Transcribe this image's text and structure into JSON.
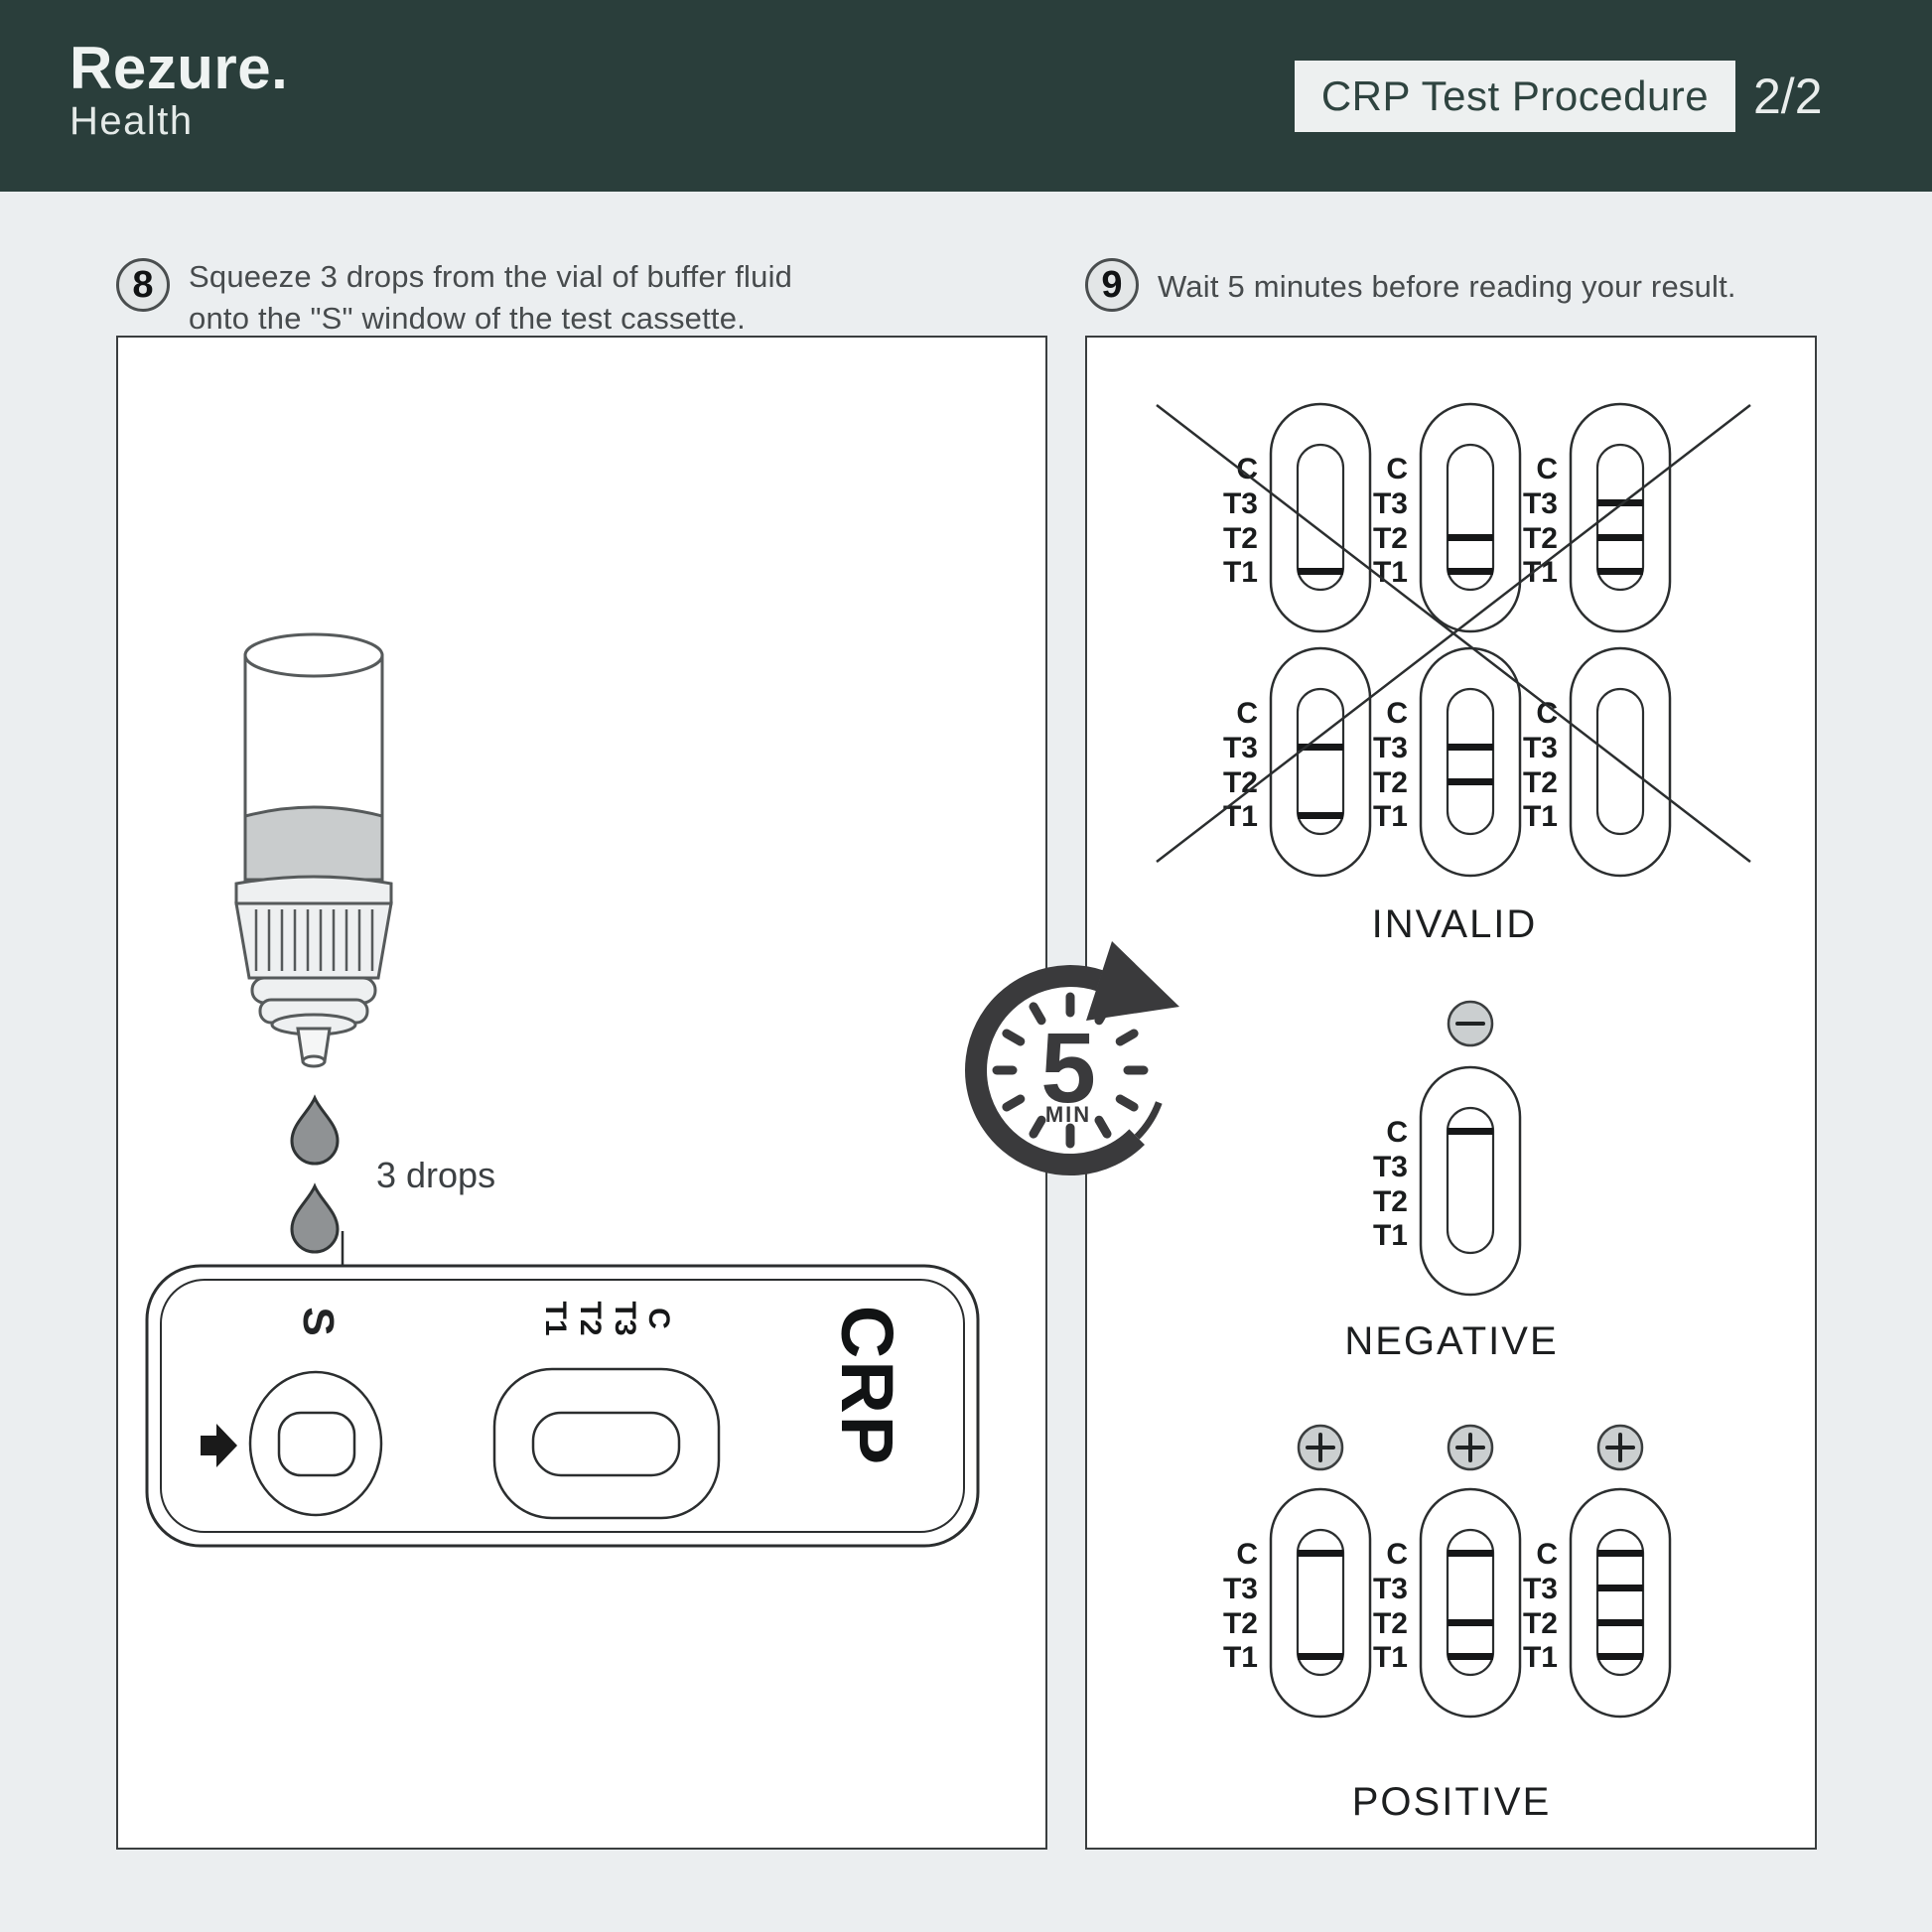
{
  "header": {
    "brand": "Rezure.",
    "brand_sub": "Health",
    "title": "CRP Test Procedure",
    "page_indicator": "2/2"
  },
  "steps": {
    "step8": {
      "number": "8",
      "line1": "Squeeze 3 drops from the vial of buffer fluid",
      "line2": "onto the \"S\" window of the test cassette."
    },
    "step9": {
      "number": "9",
      "line1": "Wait 5 minutes before reading your result."
    }
  },
  "left_panel": {
    "drops_annotation": "3 drops",
    "cassette": {
      "sample_well_label": "S",
      "window_labels": [
        "T1",
        "T2",
        "T3",
        "C"
      ],
      "assay_name": "CRP"
    }
  },
  "timer": {
    "value": "5",
    "unit": "MIN"
  },
  "results_panel": {
    "row_labels": [
      "C",
      "T3",
      "T2",
      "T1"
    ],
    "sections": [
      {
        "id": "invalid",
        "label": "INVALID",
        "crossed": true,
        "badge": null,
        "cassettes": [
          {
            "lines": [
              "T1"
            ]
          },
          {
            "lines": [
              "T2",
              "T1"
            ]
          },
          {
            "lines": [
              "T3",
              "T2",
              "T1"
            ]
          },
          {
            "lines": [
              "T3",
              "T1"
            ]
          },
          {
            "lines": [
              "T3",
              "T2"
            ]
          },
          {
            "lines": []
          }
        ]
      },
      {
        "id": "negative",
        "label": "NEGATIVE",
        "crossed": false,
        "badge": "minus",
        "cassettes": [
          {
            "lines": [
              "C"
            ]
          }
        ]
      },
      {
        "id": "positive",
        "label": "POSITIVE",
        "crossed": false,
        "badge": "plus",
        "cassettes": [
          {
            "lines": [
              "C",
              "T1"
            ]
          },
          {
            "lines": [
              "C",
              "T2",
              "T1"
            ]
          },
          {
            "lines": [
              "C",
              "T3",
              "T2",
              "T1"
            ]
          }
        ]
      }
    ]
  },
  "colors": {
    "header_bg": "#2a3e3b",
    "page_bg": "#ebeef0",
    "panel_bg": "#ffffff",
    "line_ink": "#2b2e2f",
    "bottle_ink": "#565a5b",
    "drop_fill": "#8f9294",
    "badge_fill": "#cbcfd0",
    "bar_fill": "#161718",
    "timer_ink": "#3a3a3c"
  }
}
